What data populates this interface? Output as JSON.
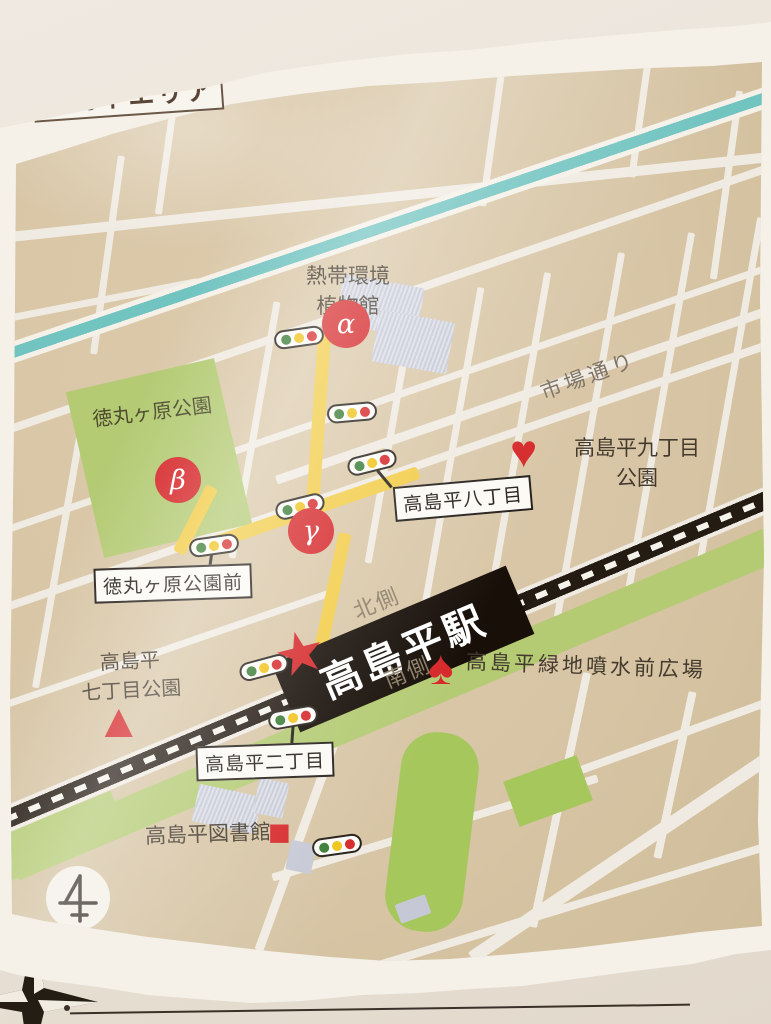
{
  "title": "高島平エリア",
  "labels": {
    "botanical_line1": "熱帯環境",
    "botanical_line2": "植物館",
    "ichiba_dori": "市場通り",
    "park9_line1": "高島平九丁目",
    "park9_line2": "公園",
    "tokumaru_park": "徳丸ヶ原公園",
    "chome8_box": "高島平八丁目",
    "tokumaru_mae_box": "徳丸ヶ原公園前",
    "north_side": "北側",
    "south_side": "南側",
    "station_name": "高島平駅",
    "fountain_plaza": "高島平緑地噴水前広場",
    "park7_line1": "高島平",
    "park7_line2": "七丁目公園",
    "chome2_box": "高島平二丁目",
    "library": "高島平図書館"
  },
  "markers": {
    "alpha": "α",
    "beta": "β",
    "gamma": "γ",
    "heart": "♥",
    "spade": "♠",
    "star": "★",
    "triangle": "▲",
    "square": "■"
  },
  "colors": {
    "marker_red": "#d6282a",
    "route_yellow": "#f2cd49",
    "river_teal": "#72c4c1",
    "park_green": "#b4cb74",
    "rail_black": "#241b12",
    "map_tan": "#d7c5a5"
  }
}
